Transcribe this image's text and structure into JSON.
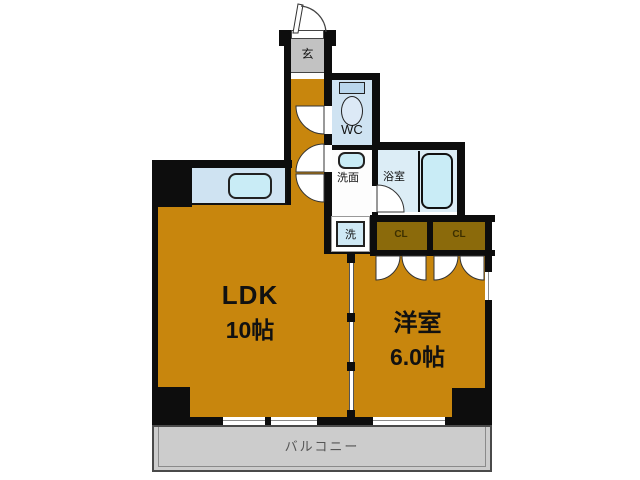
{
  "floorplan": {
    "title": "1LDK apartment floor plan",
    "rooms": {
      "genkan": {
        "label": "玄"
      },
      "wc": {
        "label": "WC"
      },
      "washroom": {
        "label": "洗面"
      },
      "bathroom": {
        "label": "浴室"
      },
      "laundry": {
        "label": "洗"
      },
      "closet1": {
        "label": "CL"
      },
      "closet2": {
        "label": "CL"
      },
      "ldk": {
        "name": "LDK",
        "size": "10帖"
      },
      "western_room": {
        "name": "洋室",
        "size": "6.0帖"
      },
      "balcony": {
        "label": "バルコニー"
      }
    },
    "colors": {
      "room_floor_orange": "#c8860d",
      "closet_brown": "#8b6a0b",
      "wall_black": "#0d0d0d",
      "water_area_blue": "#cfe3f2",
      "bathroom_blue": "#dcedf6",
      "fixture_blue": "#c9ecf6",
      "genkan_gray": "#c2c2c2",
      "balcony_gray": "#cccccc",
      "background": "#ffffff"
    }
  }
}
